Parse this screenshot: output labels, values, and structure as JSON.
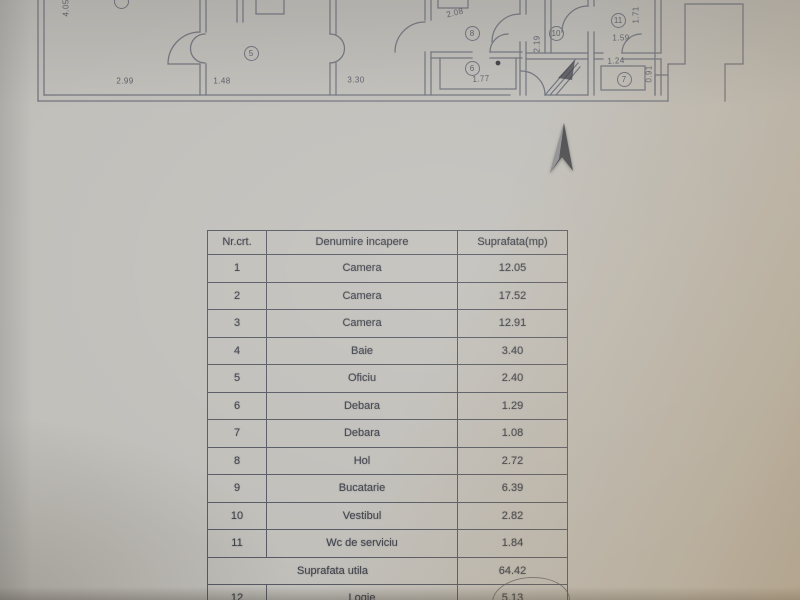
{
  "colors": {
    "paper": "#c1bfba",
    "plan_line": "#6f737e",
    "table_border": "#565963",
    "ink": "#3d4049",
    "warm_corner": "#b3a48a",
    "north_arrow": "#4a4b4f"
  },
  "floor_plan": {
    "dimensions": [
      {
        "label": "2.99",
        "x": 125,
        "y": 81,
        "rot": 0
      },
      {
        "label": "1.48",
        "x": 222,
        "y": 81,
        "rot": 0
      },
      {
        "label": "3.30",
        "x": 356,
        "y": 80,
        "rot": 0
      },
      {
        "label": "1.77",
        "x": 481,
        "y": 79,
        "rot": -4
      },
      {
        "label": "2.08",
        "x": 455,
        "y": 13,
        "rot": -14
      },
      {
        "label": "1.59",
        "x": 621,
        "y": 38,
        "rot": 0
      },
      {
        "label": "1.24",
        "x": 616,
        "y": 61,
        "rot": -3
      },
      {
        "label": "4.05",
        "x": 66,
        "y": 8,
        "rot": -90
      },
      {
        "label": "1.71",
        "x": 636,
        "y": 15,
        "rot": -90
      },
      {
        "label": "2.19",
        "x": 537,
        "y": 44,
        "rot": -90
      },
      {
        "label": "0.91",
        "x": 649,
        "y": 74,
        "rot": -90
      }
    ],
    "room_numbers": [
      {
        "label": "5",
        "x": 251,
        "y": 53
      },
      {
        "label": "8",
        "x": 472,
        "y": 33
      },
      {
        "label": "6",
        "x": 472,
        "y": 68
      },
      {
        "label": "10",
        "x": 556,
        "y": 33
      },
      {
        "label": "11",
        "x": 618,
        "y": 20
      },
      {
        "label": "7",
        "x": 624,
        "y": 79
      },
      {
        "label": "",
        "x": 121,
        "y": 1
      }
    ]
  },
  "table": {
    "headers": [
      "Nr.crt.",
      "Denumire incapere",
      "Suprafata(mp)"
    ],
    "rows": [
      {
        "nr": "1",
        "name": "Camera",
        "area": "12.05"
      },
      {
        "nr": "2",
        "name": "Camera",
        "area": "17.52"
      },
      {
        "nr": "3",
        "name": "Camera",
        "area": "12.91"
      },
      {
        "nr": "4",
        "name": "Baie",
        "area": "3.40"
      },
      {
        "nr": "5",
        "name": "Oficiu",
        "area": "2.40"
      },
      {
        "nr": "6",
        "name": "Debara",
        "area": "1.29"
      },
      {
        "nr": "7",
        "name": "Debara",
        "area": "1.08"
      },
      {
        "nr": "8",
        "name": "Hol",
        "area": "2.72"
      },
      {
        "nr": "9",
        "name": "Bucatarie",
        "area": "6.39"
      },
      {
        "nr": "10",
        "name": "Vestibul",
        "area": "2.82"
      },
      {
        "nr": "11",
        "name": "Wc de serviciu",
        "area": "1.84"
      },
      {
        "nr": "",
        "name": "Suprafata utila",
        "area": "64.42",
        "merged": true
      },
      {
        "nr": "12",
        "name": "Logie",
        "area": "5.13"
      }
    ]
  }
}
